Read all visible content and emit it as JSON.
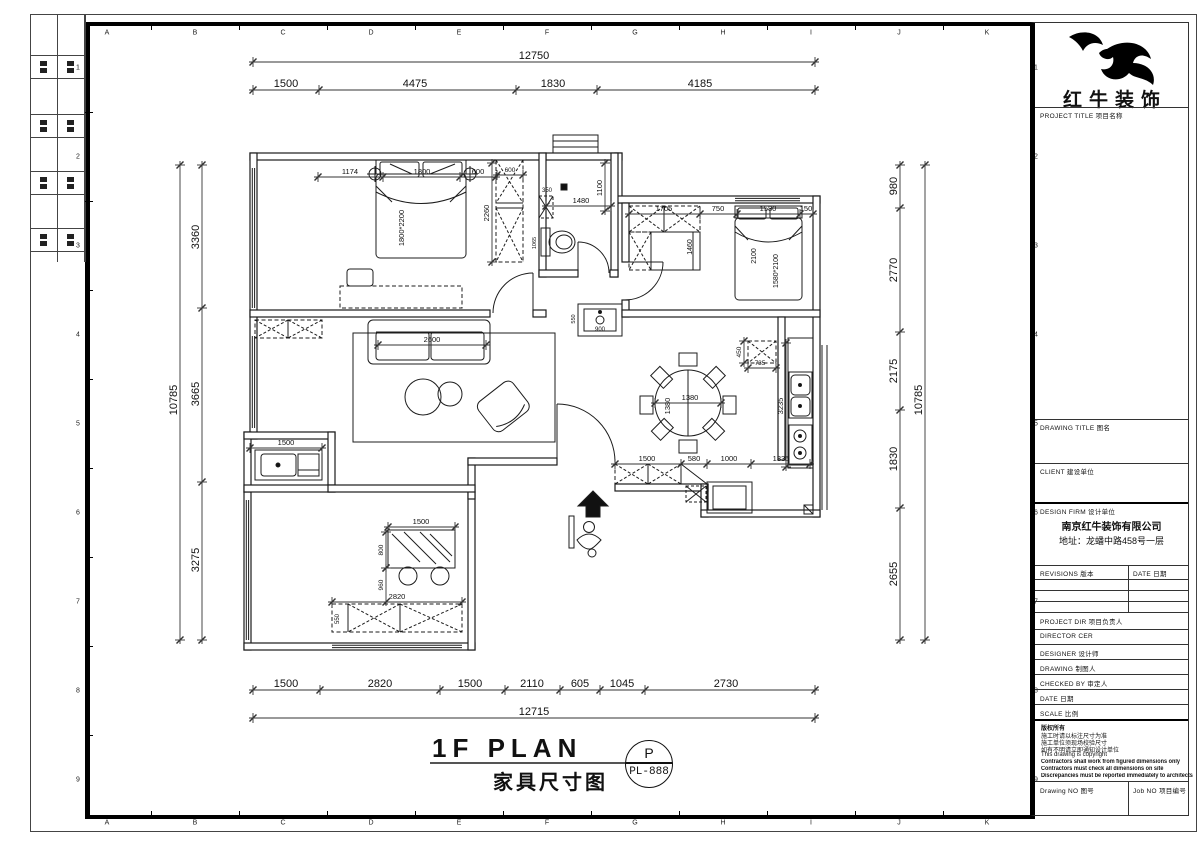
{
  "sheet": {
    "grid_letters": [
      "A",
      "B",
      "C",
      "D",
      "E",
      "F",
      "G",
      "H",
      "I",
      "J",
      "K"
    ],
    "grid_numbers": [
      "1",
      "2",
      "3",
      "4",
      "5",
      "6",
      "7",
      "8",
      "9"
    ]
  },
  "title_block": {
    "logo_text": "红牛装饰",
    "project_title": "PROJECT TITLE  项目名称",
    "drawing_title": "DRAWING TITLE  图名",
    "client": "CLIENT  建设单位",
    "design_firm": "DESIGN FIRM  设计单位",
    "company_name": "南京红牛装饰有限公司",
    "company_addr": "地址：龙蟠中路458号一层",
    "revisions": "REVISIONS  版本",
    "date_col": "DATE  日期",
    "project_dir": "PROJECT DIR  项目负责人",
    "director": "DIRECTOR CER",
    "designer": "DESIGNER  设计师",
    "drawing": "DRAWING  制图人",
    "checked_by": "CHECKED BY  审定人",
    "date": "DATE  日期",
    "scale": "SCALE  比例",
    "copyright": [
      "版权所有",
      "施工时请以标注尺寸为准",
      "施工单位须现场校验尺寸",
      "如有不明请立即通知设计单位",
      "This drawing is copyright",
      "Contractors shall work from figured dimensions only",
      "Contractors must check all dimensions on site",
      "Discrepancies must be reported immediately to architects"
    ],
    "drawing_no": "Drawing NO  图号",
    "job_no": "Job NO  项目编号"
  },
  "plan_title": {
    "en": "1F PLAN",
    "zh": "家具尺寸图",
    "stamp_letter": "P",
    "stamp_code": "PL-888"
  },
  "floor_plan": {
    "chains": [
      {
        "dir": "h",
        "y": 62,
        "x1": 253,
        "x2": 815,
        "ticks": [
          253,
          815
        ],
        "s": 11,
        "labels": [
          {
            "t": "12750",
            "x": 534
          }
        ]
      },
      {
        "dir": "h",
        "y": 90,
        "x1": 253,
        "x2": 815,
        "ticks": [
          253,
          319,
          516,
          597,
          815
        ],
        "s": 11,
        "labels": [
          {
            "t": "1500",
            "x": 286
          },
          {
            "t": "4475",
            "x": 415
          },
          {
            "t": "1830",
            "x": 553
          },
          {
            "t": "4185",
            "x": 700
          }
        ]
      },
      {
        "dir": "h",
        "y": 690,
        "x1": 253,
        "x2": 815,
        "ticks": [
          253,
          320,
          440,
          505,
          560,
          600,
          645,
          815
        ],
        "s": 11,
        "labels": [
          {
            "t": "1500",
            "x": 286
          },
          {
            "t": "2820",
            "x": 380
          },
          {
            "t": "1500",
            "x": 470
          },
          {
            "t": "2110",
            "x": 532
          },
          {
            "t": "605",
            "x": 580
          },
          {
            "t": "1045",
            "x": 622
          },
          {
            "t": "2730",
            "x": 726
          }
        ]
      },
      {
        "dir": "h",
        "y": 718,
        "x1": 253,
        "x2": 815,
        "ticks": [
          253,
          815
        ],
        "s": 11,
        "labels": [
          {
            "t": "12715",
            "x": 534
          }
        ]
      },
      {
        "dir": "v",
        "x": 180,
        "y1": 165,
        "y2": 640,
        "ticks": [
          165,
          640
        ],
        "s": 11,
        "labels": [
          {
            "t": "10785",
            "y": 400
          }
        ]
      },
      {
        "dir": "v",
        "x": 202,
        "y1": 165,
        "y2": 640,
        "ticks": [
          165,
          308,
          482,
          640
        ],
        "s": 11,
        "labels": [
          {
            "t": "3360",
            "y": 237
          },
          {
            "t": "3665",
            "y": 394
          },
          {
            "t": "3275",
            "y": 560
          }
        ]
      },
      {
        "dir": "v",
        "x": 900,
        "y1": 165,
        "y2": 640,
        "ticks": [
          165,
          208,
          332,
          410,
          508,
          640
        ],
        "s": 11,
        "labels": [
          {
            "t": "980",
            "y": 186
          },
          {
            "t": "2770",
            "y": 270
          },
          {
            "t": "2175",
            "y": 371
          },
          {
            "t": "1830",
            "y": 459
          },
          {
            "t": "2655",
            "y": 574
          }
        ]
      },
      {
        "dir": "v",
        "x": 925,
        "y1": 165,
        "y2": 640,
        "ticks": [
          165,
          640
        ],
        "s": 11,
        "labels": [
          {
            "t": "10785",
            "y": 400
          }
        ]
      },
      {
        "dir": "h",
        "y": 464,
        "x1": 615,
        "x2": 810,
        "ticks": [
          615,
          681,
          707,
          751,
          810
        ],
        "s": 7.5,
        "labels": [
          {
            "t": "1500",
            "x": 647
          },
          {
            "t": "580",
            "x": 694
          },
          {
            "t": "1000",
            "x": 729
          },
          {
            "t": "1335",
            "x": 781
          }
        ]
      },
      {
        "dir": "h",
        "y": 527,
        "x1": 388,
        "x2": 455,
        "ticks": [
          388,
          455
        ],
        "s": 7.5,
        "labels": [
          {
            "t": "1500",
            "x": 421
          }
        ]
      },
      {
        "dir": "h",
        "y": 602,
        "x1": 332,
        "x2": 462,
        "ticks": [
          332,
          462
        ],
        "s": 7.5,
        "labels": [
          {
            "t": "2820",
            "x": 397
          }
        ]
      },
      {
        "dir": "h",
        "y": 448,
        "x1": 250,
        "x2": 322,
        "ticks": [
          250,
          322
        ],
        "s": 7.5,
        "labels": [
          {
            "t": "1500",
            "x": 286
          }
        ]
      },
      {
        "dir": "h",
        "y": 206,
        "x1": 546,
        "x2": 611,
        "ticks": [
          546,
          611
        ],
        "s": 7.5,
        "labels": [
          {
            "t": "1480",
            "x": 581
          }
        ]
      },
      {
        "dir": "h",
        "y": 345,
        "x1": 378,
        "x2": 486,
        "ticks": [
          378,
          486
        ],
        "s": 7.5,
        "labels": [
          {
            "t": "2600",
            "x": 432
          }
        ]
      },
      {
        "dir": "h",
        "y": 214,
        "x1": 629,
        "x2": 813,
        "ticks": [
          629,
          700,
          737,
          800,
          813
        ],
        "s": 7.5,
        "labels": [
          {
            "t": "1705",
            "x": 664
          },
          {
            "t": "750",
            "x": 718
          },
          {
            "t": "1580",
            "x": 768
          },
          {
            "t": "150",
            "x": 806
          }
        ]
      },
      {
        "dir": "h",
        "y": 177,
        "x1": 318,
        "x2": 496,
        "ticks": [
          318,
          383,
          460,
          496
        ],
        "s": 7.5,
        "labels": [
          {
            "t": "1174",
            "x": 350
          },
          {
            "t": "1800",
            "x": 422
          },
          {
            "t": "600",
            "x": 478
          }
        ]
      },
      {
        "dir": "h",
        "y": 175,
        "x1": 497,
        "x2": 523,
        "ticks": [
          497,
          523
        ],
        "s": 6.5,
        "labels": [
          {
            "t": "600",
            "x": 510
          }
        ]
      },
      {
        "dir": "v",
        "x": 492,
        "y1": 163,
        "y2": 262,
        "ticks": [
          163,
          262
        ],
        "s": 7.5,
        "labels": [
          {
            "t": "2260",
            "y": 213
          }
        ]
      },
      {
        "dir": "v",
        "x": 605,
        "y1": 163,
        "y2": 211,
        "ticks": [
          163,
          211
        ],
        "s": 7.5,
        "labels": [
          {
            "t": "1100",
            "y": 188
          }
        ]
      },
      {
        "dir": "v",
        "x": 786,
        "y1": 343,
        "y2": 467,
        "ticks": [
          343,
          467
        ],
        "s": 7.5,
        "labels": [
          {
            "t": "3235",
            "y": 406
          }
        ]
      },
      {
        "dir": "h",
        "y": 368,
        "x1": 748,
        "x2": 776,
        "ticks": [
          748,
          776
        ],
        "s": 6.5,
        "labels": [
          {
            "t": "735",
            "x": 760
          }
        ]
      },
      {
        "dir": "v",
        "x": 744,
        "y1": 341,
        "y2": 363,
        "ticks": [
          341,
          363
        ],
        "s": 6.5,
        "labels": [
          {
            "t": "450",
            "y": 352
          }
        ]
      },
      {
        "dir": "h",
        "y": 403,
        "x1": 655,
        "x2": 721,
        "ticks": [
          655,
          721
        ],
        "s": 7.5,
        "labels": [
          {
            "t": "1380",
            "x": 690
          }
        ]
      },
      {
        "dir": "v",
        "x": 386,
        "y1": 532,
        "y2": 568,
        "ticks": [
          532,
          568
        ],
        "s": 6.5,
        "labels": [
          {
            "t": "800",
            "y": 550
          }
        ]
      },
      {
        "dir": "v",
        "x": 386,
        "y1": 568,
        "y2": 602,
        "ticks": [
          568,
          602
        ],
        "s": 6.5,
        "labels": [
          {
            "t": "960",
            "y": 585
          }
        ]
      }
    ],
    "labels": [
      {
        "t": "1800*2200",
        "x": 404,
        "y": 228,
        "r": -90,
        "s": 7.5
      },
      {
        "t": "1380",
        "x": 670,
        "y": 406,
        "r": -90,
        "s": 7.5
      },
      {
        "t": "1460",
        "x": 692,
        "y": 247,
        "r": -90,
        "s": 7
      },
      {
        "t": "2100",
        "x": 756,
        "y": 256,
        "r": -90,
        "s": 7
      },
      {
        "t": "1580*2100",
        "x": 778,
        "y": 271,
        "r": -90,
        "s": 7
      },
      {
        "t": "350",
        "x": 547,
        "y": 192,
        "r": 0,
        "s": 6
      },
      {
        "t": "1065",
        "x": 536,
        "y": 243,
        "r": -90,
        "s": 5.5
      },
      {
        "t": "900",
        "x": 600,
        "y": 331,
        "r": 0,
        "s": 6
      },
      {
        "t": "550",
        "x": 575,
        "y": 319,
        "r": -90,
        "s": 5.5
      },
      {
        "t": "550",
        "x": 339,
        "y": 619,
        "r": -90,
        "s": 6
      }
    ]
  }
}
